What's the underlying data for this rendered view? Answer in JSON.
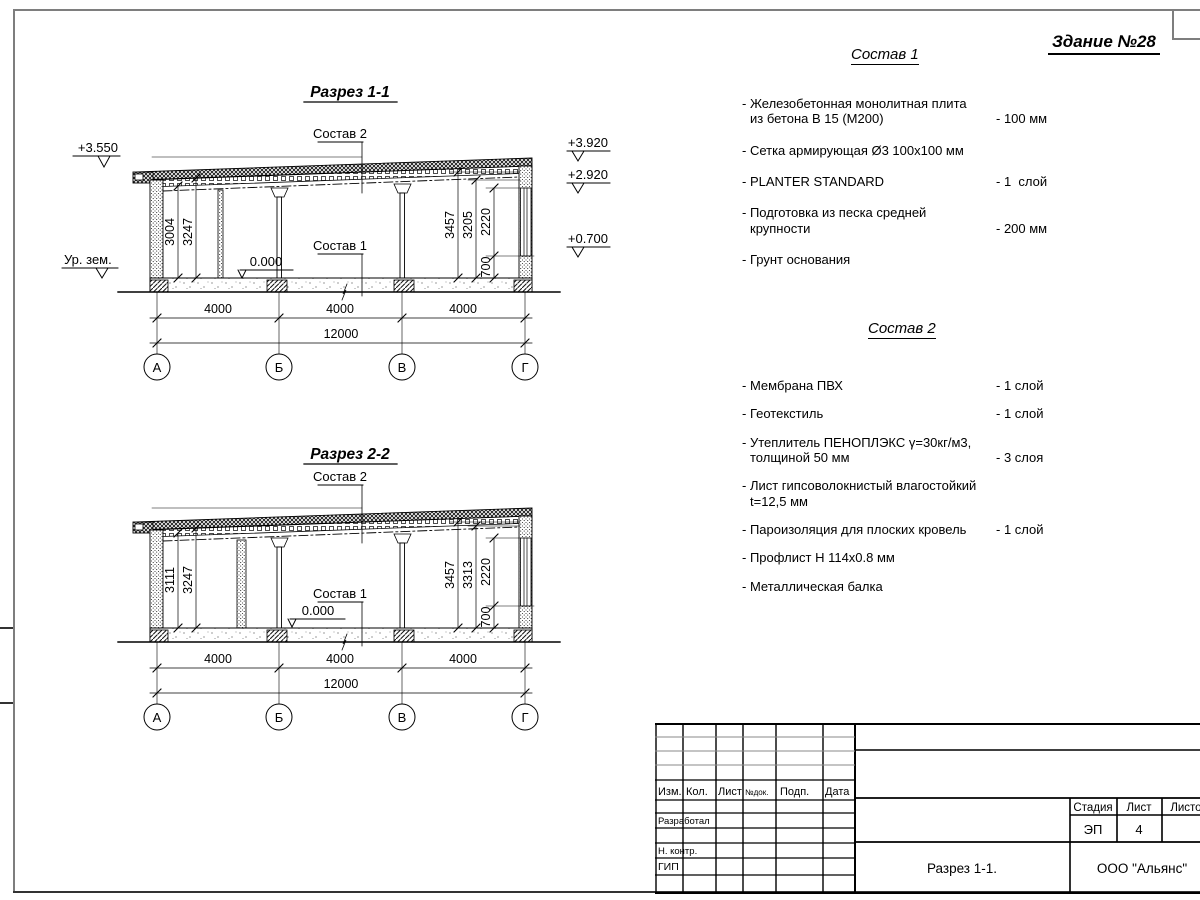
{
  "page": {
    "building_no": "Здание №28"
  },
  "sostav1": {
    "title": "Состав 1",
    "items": [
      {
        "name": "- Железобетонная  монолитная плита\nиз бетона В 15 (М200)",
        "qty": "- 100 мм"
      },
      {
        "name": "- Сетка армирующая Ø3 100х100 мм",
        "qty": ""
      },
      {
        "name": "- PLANTER STANDARD",
        "qty": "- 1  слой"
      },
      {
        "name": "- Подготовка из песка средней\nкрупности",
        "qty": "- 200 мм"
      },
      {
        "name": "- Грунт основания",
        "qty": ""
      }
    ]
  },
  "sostav2": {
    "title": "Состав 2",
    "items": [
      {
        "name": "- Мембрана ПВХ",
        "qty": "- 1 слой"
      },
      {
        "name": "- Геотекстиль",
        "qty": "- 1 слой"
      },
      {
        "name": "- Утеплитель ПЕНОПЛЭКС γ=30кг/м3,\nтолщиной 50 мм",
        "qty": "- 3 слоя"
      },
      {
        "name": "- Лист гипсоволокнистый влагостойкий\nt=12,5 мм",
        "qty": ""
      },
      {
        "name": "- Пароизоляция для плоских кровель",
        "qty": "- 1 слой"
      },
      {
        "name": "- Профлист Н 114х0.8 мм",
        "qty": ""
      },
      {
        "name": "- Металлическая балка",
        "qty": ""
      }
    ]
  },
  "section1": {
    "title": "Разрез 1-1",
    "layer2_label": "Состав 2",
    "layer1_label": "Состав 1",
    "zero_level": "0.000",
    "elev_top_left": "+3.550",
    "ground_label": "Ур. зем.",
    "elev_right_1": "+3.920",
    "elev_right_2": "+2.920",
    "elev_right_3": "+0.700",
    "dim_left_1": "3004",
    "dim_left_2": "3247",
    "dim_right_1": "3457",
    "dim_right_2": "3205",
    "dim_right_3": "2220",
    "dim_right_4": "700",
    "span_1": "4000",
    "span_2": "4000",
    "span_3": "4000",
    "total": "12000",
    "axis_1": "А",
    "axis_2": "Б",
    "axis_3": "В",
    "axis_4": "Г"
  },
  "section2": {
    "title": "Разрез 2-2",
    "layer2_label": "Состав 2",
    "layer1_label": "Состав 1",
    "zero_level": "0.000",
    "dim_left_1": "3111",
    "dim_left_2": "3247",
    "dim_right_1": "3457",
    "dim_right_2": "3313",
    "dim_right_3": "2220",
    "dim_right_4": "700",
    "span_1": "4000",
    "span_2": "4000",
    "span_3": "4000",
    "total": "12000",
    "axis_1": "А",
    "axis_2": "Б",
    "axis_3": "В",
    "axis_4": "Г"
  },
  "titleblock": {
    "cols": [
      "Изм.",
      "Кол.",
      "Лист",
      "№док.",
      "Подп.",
      "Дата"
    ],
    "razrabotal": "Разработал",
    "nkontr": "Н. контр.",
    "gip": "ГИП",
    "stage_label": "Стадия",
    "sheet_label": "Лист",
    "sheets_label": "Листов",
    "stage_value": "ЭП",
    "sheet_value": "4",
    "doc_title": "Разрез 1-1.",
    "company": "ООО \"Альянс\""
  }
}
